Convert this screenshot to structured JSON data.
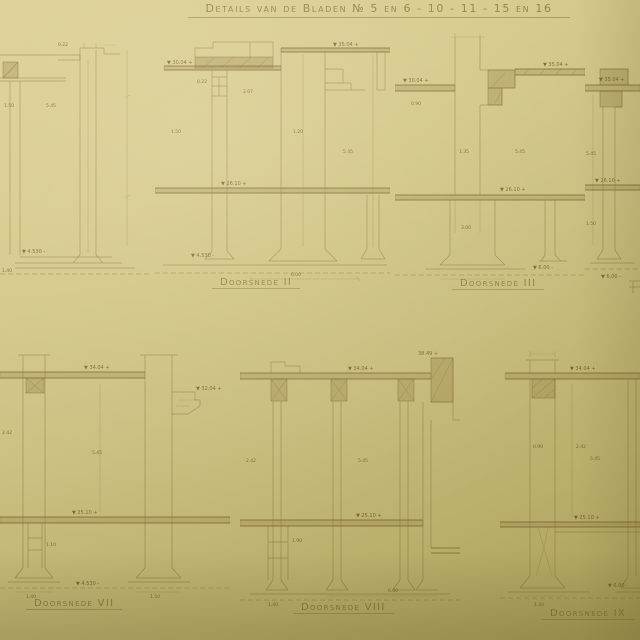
{
  "page": {
    "title": "Details van de Bladen № 5 en 6 - 10 - 11 - 15 en 16",
    "paper_color": "#c9bd7e",
    "ink_color": "#8a7747"
  },
  "sections": [
    {
      "name": "section-left-partial",
      "label": "",
      "ann": [
        "1.50",
        "5.45",
        "▼ 4.530 -",
        "1.40",
        "0.22"
      ]
    },
    {
      "name": "doorsnede-ii",
      "label": "Doorsnede II",
      "ann": [
        "▼ 35.04 +",
        "▼ 30.04 +",
        "▼ 26.10 +",
        "▼ 4.530 -",
        "6.00",
        "1.20",
        "2.07",
        "0.22",
        "5.45",
        "1.50"
      ]
    },
    {
      "name": "doorsnede-iii",
      "label": "Doorsnede III",
      "ann": [
        "▼ 35.04 +",
        "▼ 30.04 +",
        "▼ 26.10 +",
        "▼ 6.00 -",
        "1.35",
        "5.45",
        "3.00",
        "0.90"
      ]
    },
    {
      "name": "section-right-partial",
      "label": "",
      "ann": [
        "▼ 35.04 +",
        "▼ 26.10 +",
        "▼ 6.00 -",
        "5.45",
        "1.50"
      ]
    },
    {
      "name": "doorsnede-vii",
      "label": "Doorsnede VII",
      "ann": [
        "▼ 34.04 +",
        "▼ 32.04 +",
        "▼ 25.10 +",
        "▼ 4.530 -",
        "5.45",
        "2.42",
        "1.10",
        "1.40",
        "1.50"
      ]
    },
    {
      "name": "doorsnede-viii",
      "label": "Doorsnede VIII",
      "ann": [
        "▼ 34.04 +",
        "38.49 +",
        "▼ 25.10 +",
        "6.00",
        "1.90",
        "5.45",
        "2.42",
        "1.40"
      ]
    },
    {
      "name": "doorsnede-ix",
      "label": "Doorsnede IX",
      "ann": [
        "▼ 34.04 +",
        "▼ 25.10 +",
        "2.42",
        "0.90",
        "5.45",
        "1.40",
        "▼ 6.00 -"
      ]
    }
  ]
}
